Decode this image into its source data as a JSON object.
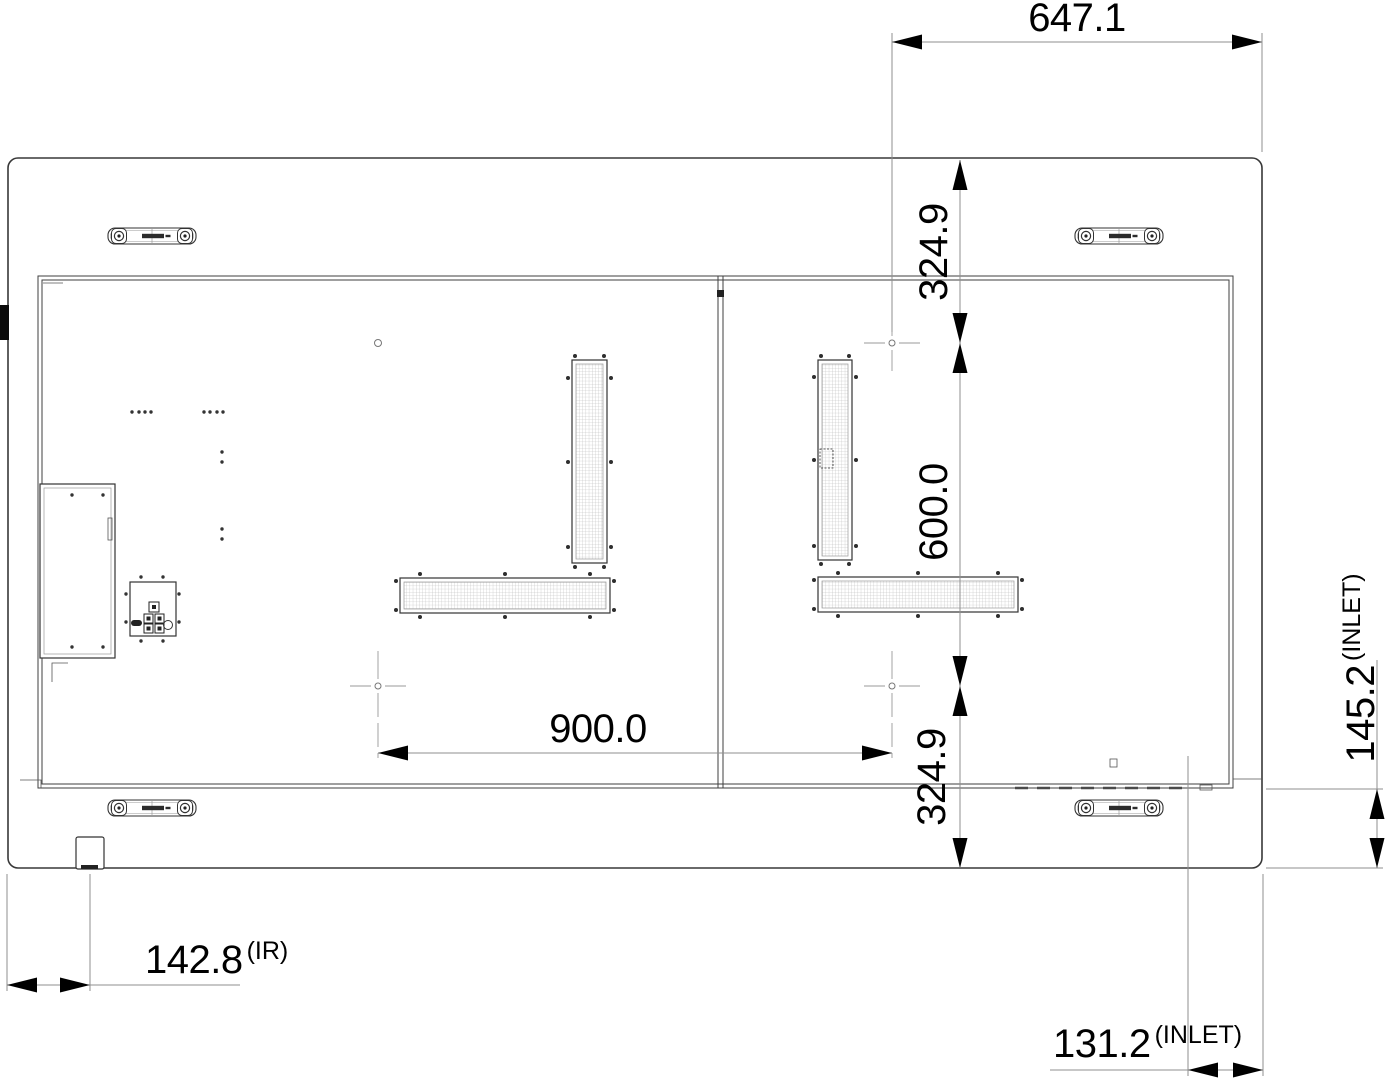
{
  "dimensions": {
    "top_width": "647.1",
    "right_upper_offset": "324.9",
    "right_mount_height": "600.0",
    "right_lower_offset": "324.9",
    "mount_width": "900.0",
    "side_inlet_value": "145.2",
    "side_inlet_note": "(INLET)",
    "ir_value": "142.8",
    "ir_note": "(IR)",
    "bottom_inlet_value": "131.2",
    "bottom_inlet_note": "(INLET)"
  }
}
